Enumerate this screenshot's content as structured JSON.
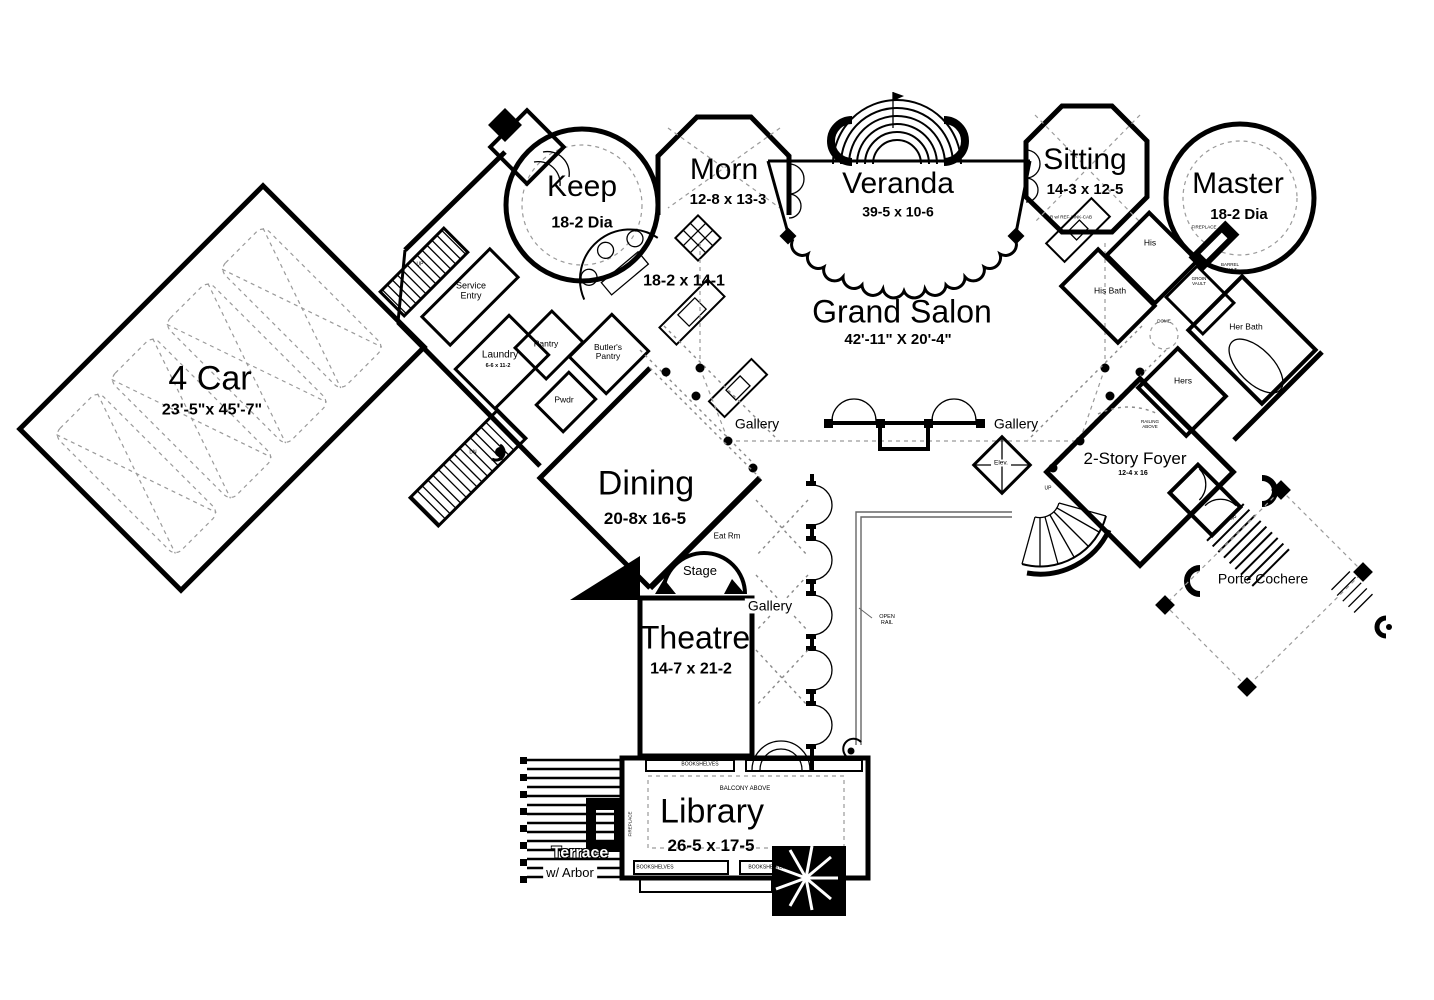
{
  "rooms": {
    "keep": {
      "name": "Keep",
      "dim": "18-2 Dia"
    },
    "morn": {
      "name": "Morn",
      "dim": "12-8 x 13-3"
    },
    "kitchen": {
      "dim": "18-2 x 14-1"
    },
    "veranda": {
      "name": "Veranda",
      "dim": "39-5 x 10-6"
    },
    "grand_salon": {
      "name": "Grand Salon",
      "dim": "42'-11\" X 20'-4\""
    },
    "sitting": {
      "name": "Sitting",
      "dim": "14-3 x 12-5"
    },
    "master": {
      "name": "Master",
      "dim": "18-2 Dia"
    },
    "garage": {
      "name": "4 Car",
      "dim": "23'-5\"x 45'-7\""
    },
    "dining": {
      "name": "Dining",
      "dim": "20-8x 16-5"
    },
    "theatre": {
      "name": "Theatre",
      "dim": "14-7 x 21-2"
    },
    "library": {
      "name": "Library",
      "dim": "26-5 x 17-5"
    },
    "foyer": {
      "name": "2-Story Foyer",
      "dim": "12-4 x 16"
    },
    "porte_cochere": {
      "name": "Porte Cochere"
    },
    "terrace": {
      "name": "Terrace",
      "sub": "w/ Arbor"
    },
    "stage": {
      "name": "Stage"
    },
    "eat_rm": {
      "name": "Eat Rm"
    },
    "gallery": {
      "name": "Gallery"
    }
  },
  "small_labels": {
    "service_entry": "Service\nEntry",
    "laundry": "Laundry",
    "laundry_dim": "6-6 x 11-2",
    "pantry": "Pantry",
    "butlers_pantry": "Butler's\nPantry",
    "pwdr": "Pwdr",
    "his": "His",
    "his_bath": "His Bath",
    "her_bath": "Her Bath",
    "hers": "Hers",
    "bar": "BAR w/ REF-SINK-CAB",
    "fireplace": "FIREPLACE",
    "barrel_vault": "BARREL\nVAULT",
    "groin_vault": "GROIN\nVAULT",
    "dome": "DOME",
    "open_rail": "OPEN\nRAIL",
    "elev": "Elev.",
    "railing_above": "RAILING\nABOVE",
    "balcony_above": "BALCONY ABOVE",
    "bookshelves": "BOOKSHELVES",
    "up": "UP",
    "dn": "DN"
  },
  "colors": {
    "ink": "#000000",
    "paper": "#ffffff",
    "dash_gray": "#9a9a9a"
  }
}
